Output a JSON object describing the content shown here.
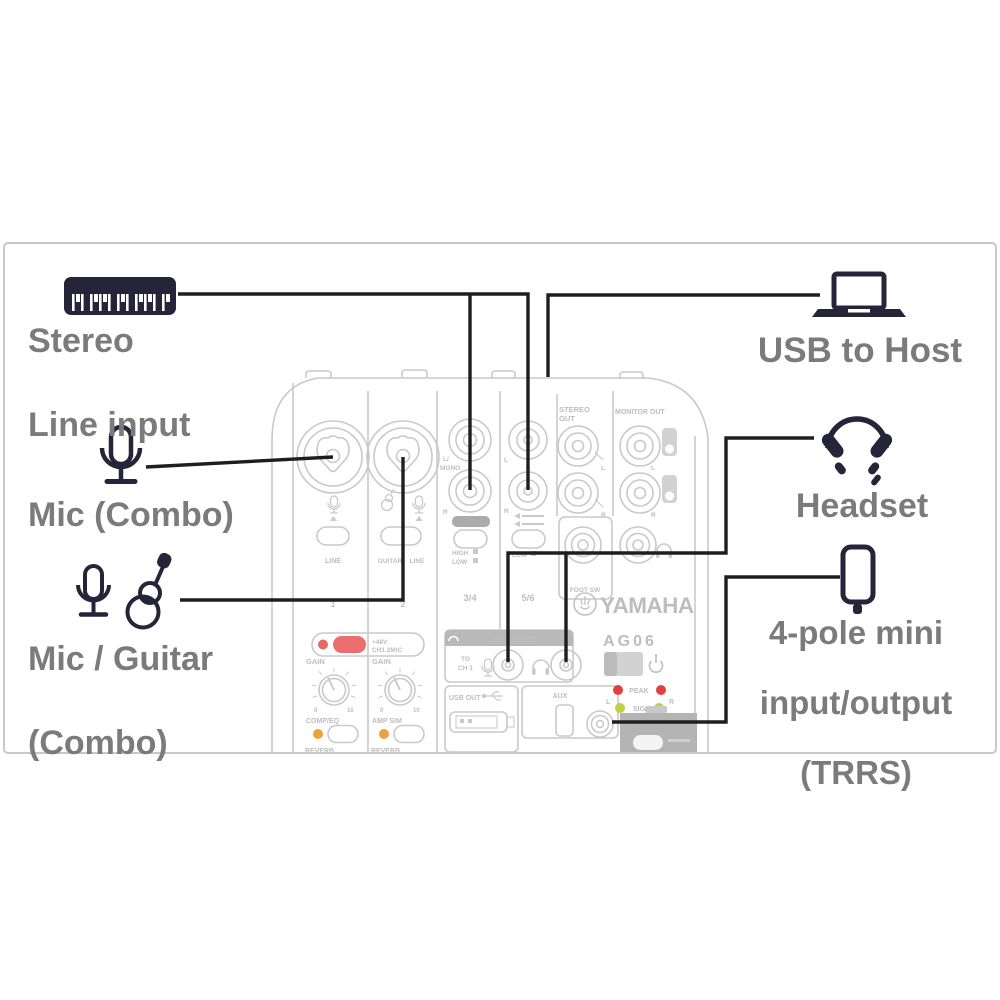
{
  "labels": {
    "stereo_line_1": "Stereo",
    "stereo_line_2": "Line input",
    "mic_combo": "Mic (Combo)",
    "mic_guitar_1": "Mic / Guitar",
    "mic_guitar_2": "(Combo)",
    "usb_to_host": "USB to Host",
    "headset": "Headset",
    "trrs_1": "4-pole mini",
    "trrs_2": "input/output",
    "trrs_3": "(TRRS)"
  },
  "mixer": {
    "brand": "YAMAHA",
    "model": "AG06",
    "panel": {
      "stereo_out_1": "STEREO",
      "stereo_out_2": "OUT",
      "monitor_out": "MONITOR OUT",
      "l_mono_1": "L/",
      "l_mono_2": "MONO",
      "r": "R",
      "l": "L",
      "ch34": "3/4",
      "ch56": "5/6",
      "high": "HIGH",
      "low": "LOW",
      "foot_sw": "FOOT SW",
      "headset": "HEADSET",
      "to": "TO",
      "ch1_label": "CH 1",
      "usb_out": "USB OUT",
      "aux": "AUX",
      "phantom_1": "+48V",
      "phantom_2": "CH1 2MIC",
      "gain": "GAIN",
      "comp_eq": "COMP/EQ",
      "amp_sim": "AMP SIM",
      "reverb": "REVERB",
      "line": "LINE",
      "guitar": "GUITAR",
      "peak": "PEAK",
      "sig": "SIG",
      "num1": "1",
      "num2": "2",
      "zero": "0",
      "ten": "10"
    }
  },
  "icons": {
    "keyboard": "keyboard-icon",
    "laptop": "laptop-icon",
    "microphone": "microphone-icon",
    "guitar": "guitar-icon",
    "headphones": "headphones-icon",
    "smartphone": "smartphone-icon"
  },
  "colors": {
    "label_gray": "#7b7b7b",
    "icon_navy": "#262438",
    "connection_line": "#1e1e1e",
    "panel_gray": "#c9c9c9",
    "frame_gray": "#c8c8c8",
    "accent_red": "#ec6d6d",
    "led_red": "#e04040",
    "led_green": "#c2cf3f",
    "led_orange": "#eaa23c"
  }
}
